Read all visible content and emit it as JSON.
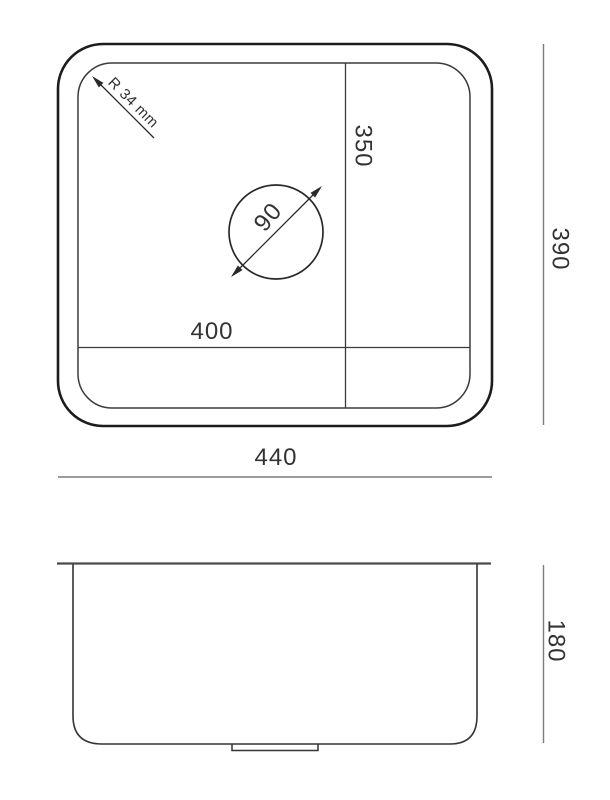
{
  "drawing": {
    "title": "Sink technical dimension drawing",
    "colors": {
      "background": "#ffffff",
      "outer_outline": "#1c1c1c",
      "drawing_line": "#3b3b3b",
      "dimension_line": "#7c7c7c",
      "text": "#333333"
    },
    "top_view": {
      "labels": {
        "corner_radius": "R 34 mm",
        "drain_diameter": "90",
        "inner_depth": "350",
        "inner_width": "400",
        "outer_depth": "390",
        "outer_width": "440"
      }
    },
    "side_view": {
      "labels": {
        "height": "180"
      }
    }
  }
}
